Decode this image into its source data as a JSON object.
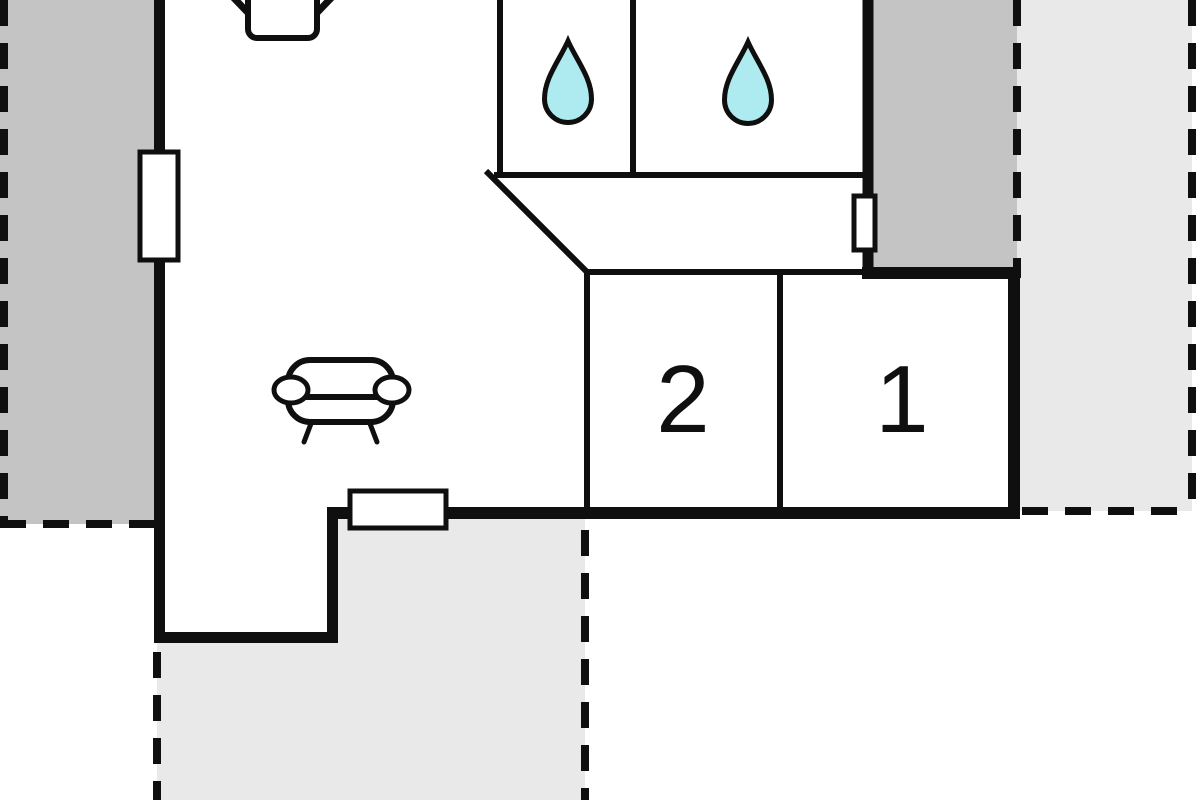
{
  "plan": {
    "type": "holiday-home-floor-plan",
    "rooms": {
      "bedroom_1": {
        "label": "1"
      },
      "bedroom_2": {
        "label": "2"
      },
      "bathroom_left": {
        "icon": "water-drop"
      },
      "bathroom_right": {
        "icon": "water-drop"
      },
      "living_room": {
        "icons": [
          "tv",
          "sofa"
        ]
      },
      "hallway": {}
    },
    "icons": [
      "tv-icon",
      "sofa-icon",
      "water-drop-icon",
      "window-marker"
    ],
    "colors": {
      "ink": "#0f0f0f",
      "terrace_dark": "#c4c4c4",
      "terrace_light": "#e9e9e9",
      "water_drop": "#aeebf0",
      "background": "#ffffff"
    }
  }
}
